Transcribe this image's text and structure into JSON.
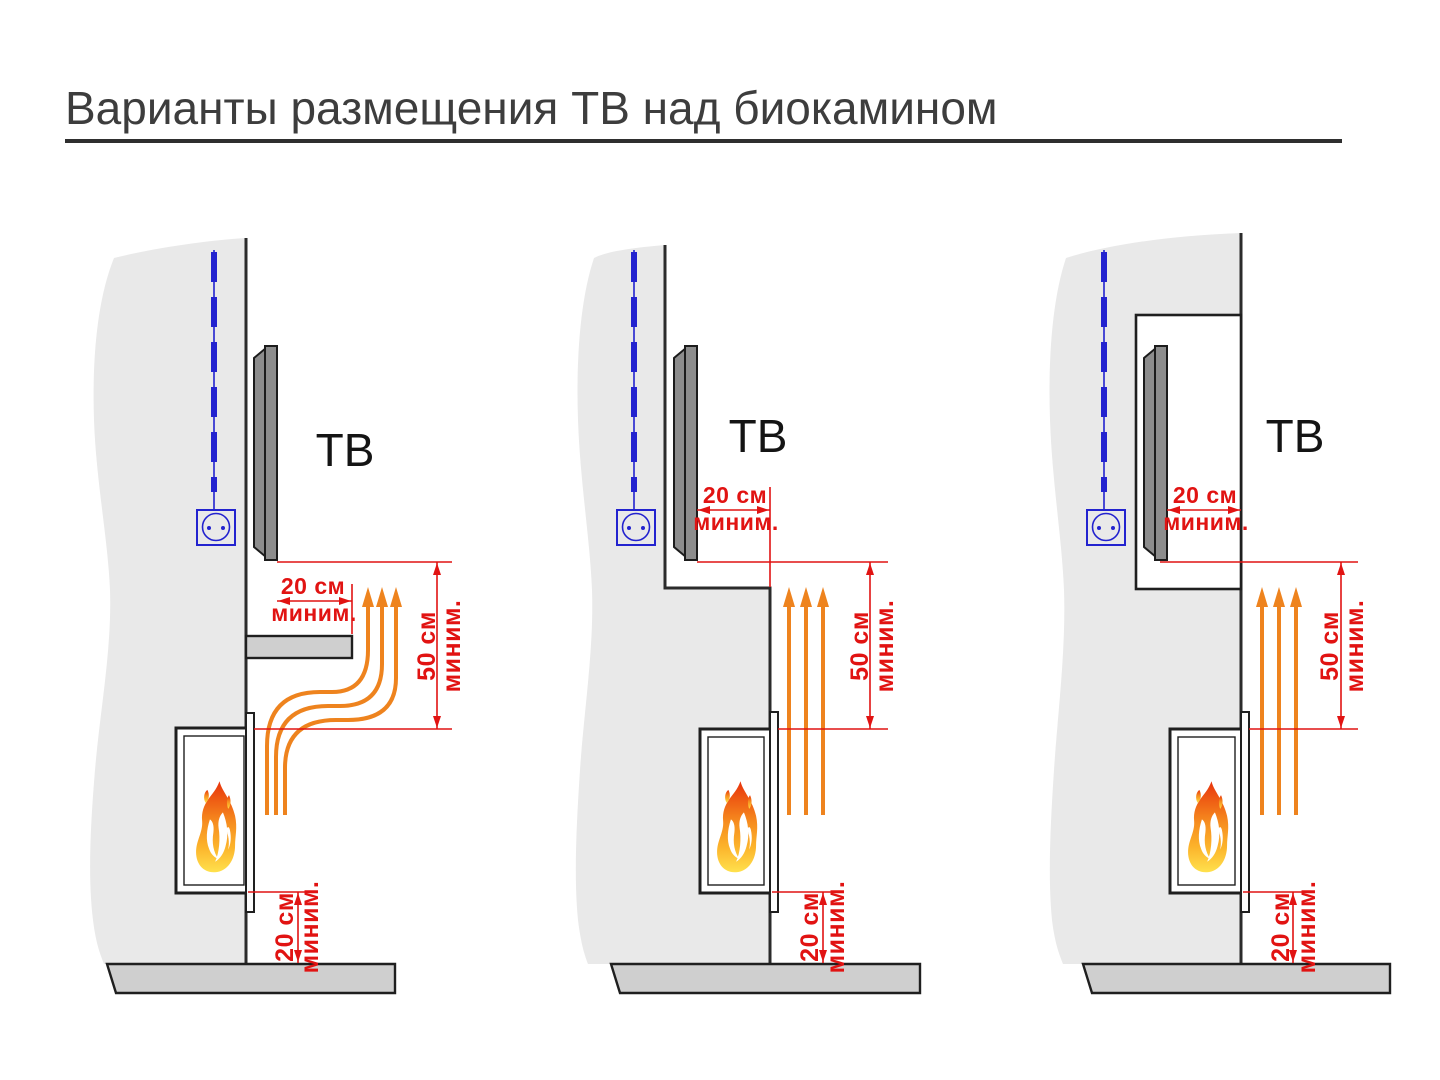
{
  "title": "Варианты размещения ТВ над биокамином",
  "colors": {
    "dimension_red": "#e11312",
    "heat_orange": "#ee831e",
    "cable_blue": "#2323cf",
    "wall_fill": "#e9e9e9",
    "slab_fill": "#cfcfcf",
    "tv_fill": "#8d8d8d",
    "outline_dark": "#1f1f1f",
    "title_color": "#3d3d3d"
  },
  "panels": [
    {
      "id": "tv-above-fireplace-with-protective-shelf",
      "tv_label": "ТВ",
      "tv_clearance": {
        "value": "20 см",
        "qualifier": "миним."
      },
      "heat_clearance": {
        "value": "50 см",
        "qualifier": "миним."
      },
      "floor_clearance": {
        "value": "20 см",
        "qualifier": "миним."
      }
    },
    {
      "id": "tv-recessed-behind-wall-step",
      "tv_label": "ТВ",
      "tv_clearance": {
        "value": "20 см",
        "qualifier": "миним."
      },
      "heat_clearance": {
        "value": "50 см",
        "qualifier": "миним."
      },
      "floor_clearance": {
        "value": "20 см",
        "qualifier": "миним."
      }
    },
    {
      "id": "tv-inside-wall-niche",
      "tv_label": "ТВ",
      "tv_clearance": {
        "value": "20 см",
        "qualifier": "миним."
      },
      "heat_clearance": {
        "value": "50 см",
        "qualifier": "миним."
      },
      "floor_clearance": {
        "value": "20 см",
        "qualifier": "миним."
      }
    }
  ]
}
